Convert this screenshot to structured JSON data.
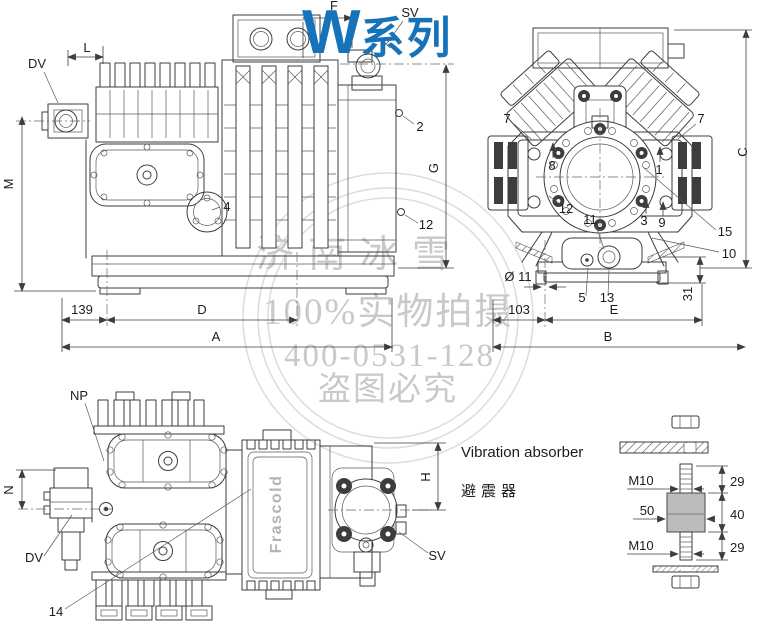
{
  "title": {
    "series_letter": "W",
    "series_word": "系列"
  },
  "colors": {
    "title_blue": "#1673b9",
    "line_dark": "#3d3d3d",
    "watermark_gray": "#c9c9c9",
    "rubber_gray": "#bcbcbc"
  },
  "watermark": {
    "line1": "济南冰雪",
    "line2": "100%实物拍摄",
    "line3": "400-0531-128",
    "line4": "盗图必究"
  },
  "side_view": {
    "dv": "DV",
    "l": "L",
    "m": "M",
    "f": "F",
    "sv": "SV",
    "part_2": "2",
    "g": "G",
    "part_12": "12",
    "part_4": "4",
    "dim_139": "139",
    "dim_d": "D",
    "dim_a": "A"
  },
  "front_view": {
    "part_7_left": "7",
    "part_7_right": "7",
    "part_8": "8",
    "part_1": "1",
    "part_12": "12",
    "part_11": "11",
    "part_3": "3",
    "part_9": "9",
    "part_15": "15",
    "part_10": "10",
    "dim_c": "C",
    "dia_11": "Ø 11",
    "part_5": "5",
    "part_13": "13",
    "dim_31": "31",
    "dim_103": "103",
    "dim_e": "E",
    "dim_b": "B"
  },
  "bottom_view": {
    "np": "NP",
    "n": "N",
    "dv": "DV",
    "part_14": "14",
    "h": "H",
    "sv": "SV",
    "brand": "Frascold"
  },
  "absorber": {
    "title_en": "Vibration absorber",
    "title_zh": "避震器",
    "m10_top": "M10",
    "dim_29_top": "29",
    "dim_50": "50",
    "dim_40": "40",
    "m10_bottom": "M10",
    "dim_29_bottom": "29"
  }
}
